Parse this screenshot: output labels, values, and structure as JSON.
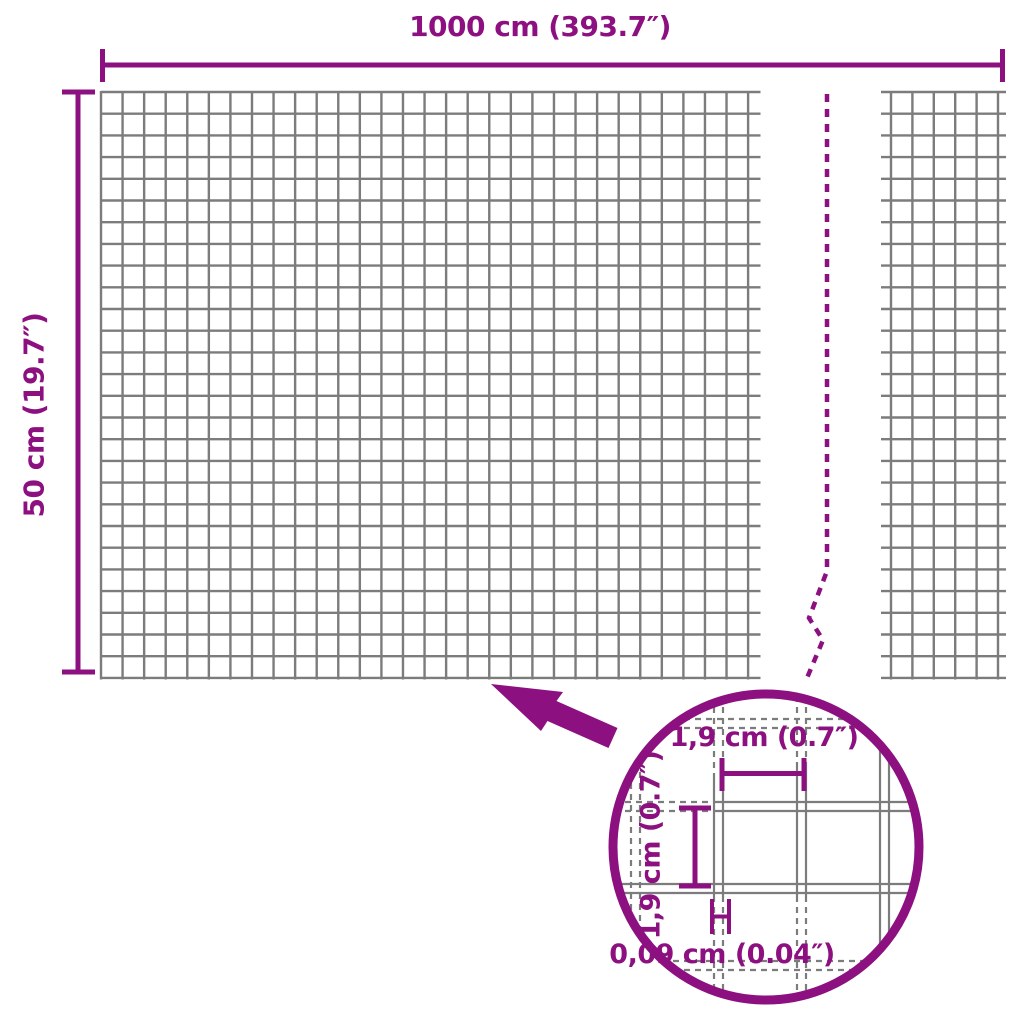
{
  "diagram": {
    "type": "product-dimension-diagram",
    "subject": "wire mesh roll",
    "overall": {
      "width_label": "1000 cm (393.7″)",
      "height_label": "50 cm (19.7″)"
    },
    "mesh_detail": {
      "opening_width_label": "1,9 cm (0.7″)",
      "opening_height_label": "1,9 cm (0.7″)",
      "wire_thickness_label": "0,09 cm (0.04″)"
    }
  },
  "colors": {
    "accent": "#8D1080",
    "grid_line": "#7C7C7C",
    "background": "#FFFFFF"
  }
}
